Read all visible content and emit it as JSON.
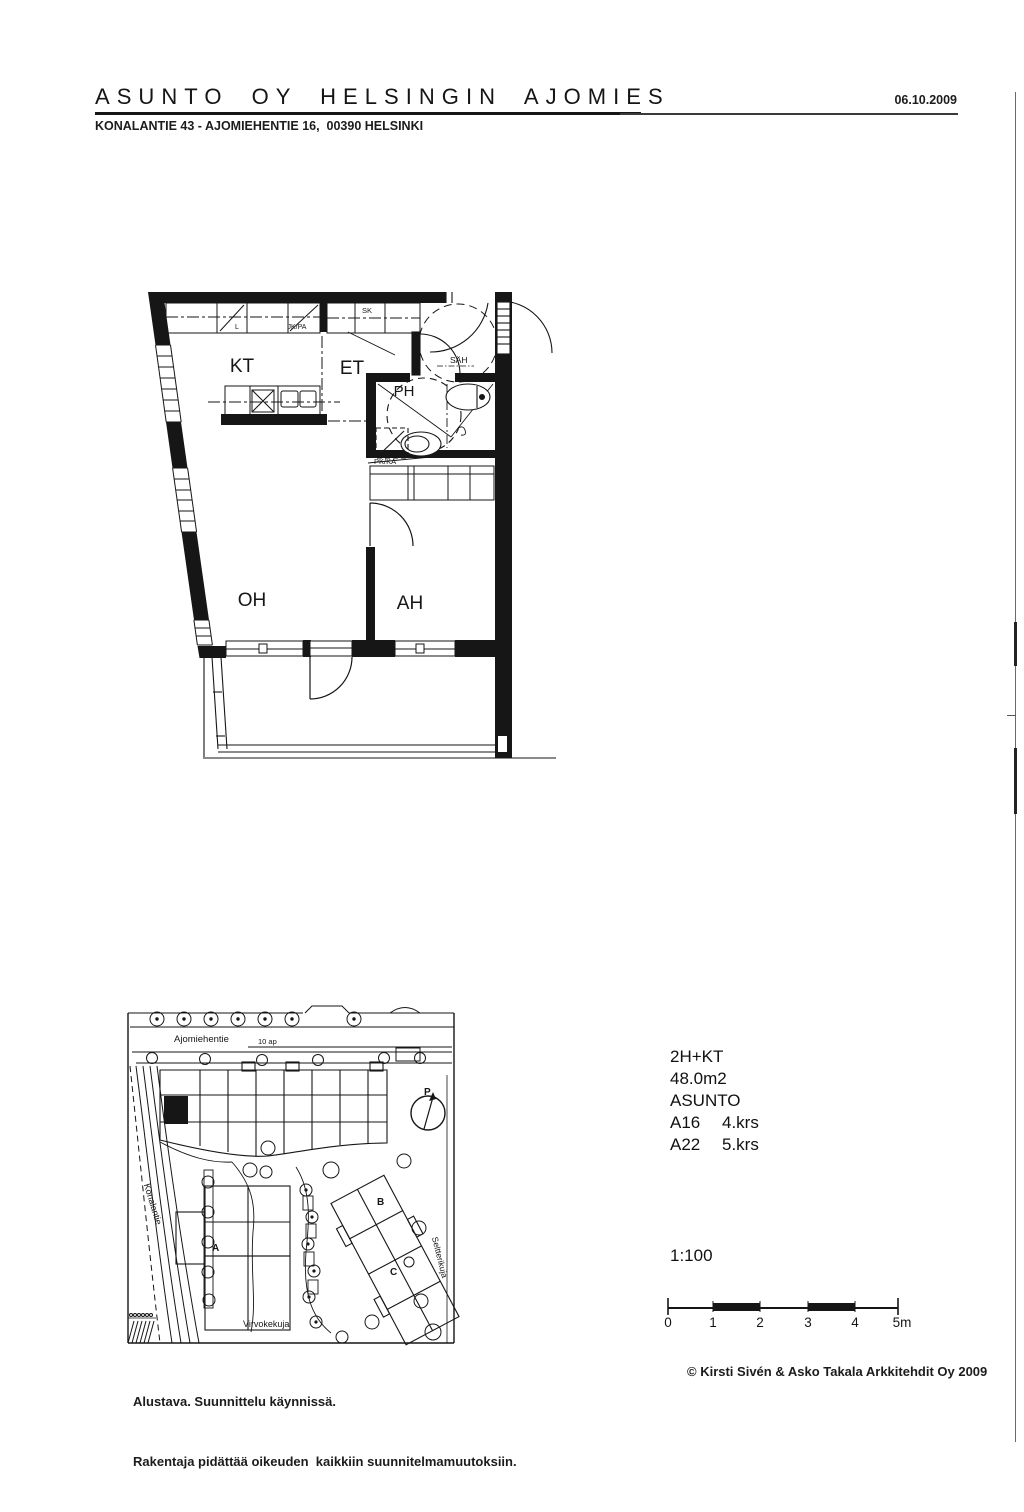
{
  "header": {
    "title": "ASUNTO OY HELSINGIN AJOMIES",
    "date": "06.10.2009",
    "address": "KONALANTIE 43 - AJOMIEHENTIE 16,  00390 HELSINKI"
  },
  "floor_plan": {
    "rooms": {
      "kitchen": "KT",
      "entry": "ET",
      "bathroom": "PH",
      "living_room": "OH",
      "bedroom": "AH"
    },
    "labels": {
      "closet": "L",
      "fridge_freezer": "JK/PA",
      "cleaning_closet": "SK",
      "washer_reservation": "PK/KA",
      "electrical": "SÄH"
    }
  },
  "site_plan": {
    "streets": {
      "north": "Ajomiehentie",
      "west": "Konalantie",
      "south": "Virvokekuja",
      "east": "Seltterikuja"
    },
    "parking_note": "10 ap",
    "building_labels": {
      "a": "A",
      "b": "B",
      "c": "C"
    },
    "compass_label": "P"
  },
  "apartment_info": {
    "type": "2H+KT",
    "area": "48.0m2",
    "label": "ASUNTO",
    "units": [
      {
        "id": "A16",
        "floor": "4.krs"
      },
      {
        "id": "A22",
        "floor": "5.krs"
      }
    ],
    "scale": "1:100"
  },
  "scale_bar": {
    "ticks": [
      "0",
      "1",
      "2",
      "3",
      "4",
      "5m"
    ]
  },
  "footer": {
    "status_line1": "Alustava. Suunnittelu käynnissä.",
    "status_line2": "Rakentaja pidättää oikeuden  kaikkiin suunnitelmamuutoksiin.",
    "copyright": "© Kirsti Sivén & Asko Takala Arkkitehdit Oy 2009"
  },
  "colors": {
    "ink": "#1a1a1a",
    "paper": "#ffffff"
  }
}
